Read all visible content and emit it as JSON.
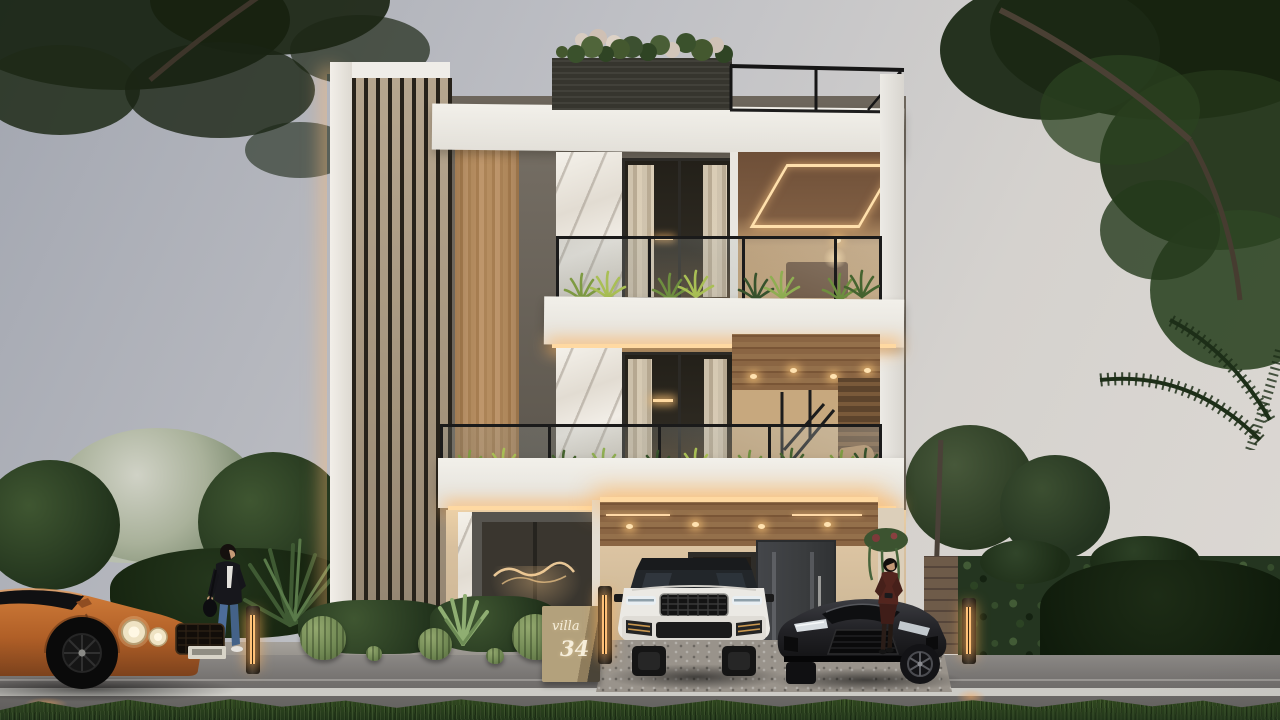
{
  "scene": {
    "description": "Photorealistic exterior render of a modern three-storey villa at dusk: warm LED accent lighting, rooftop flower planter with black railing, plant-lined glass balconies, vertical louver and wood cladding, marble piers, a carport with a white luxury SUV and a black sports coupe parked, an orange grand-tourer passing on the wet road, a woman walking on the sidewalk, a woman leaning on the sports car, cactus garden, hedges and trees under an overcast sky"
  },
  "sign": {
    "line1": "villa",
    "line2": "34"
  },
  "objects": {
    "suv": "white luxury SUV, front view",
    "sports_car": "black sports coupe, front view",
    "coupe": "orange grand tourer, side view, passing",
    "pedestrian": "woman walking with shoulder bag",
    "bystander": "woman leaning on the sports car"
  },
  "palette": {
    "sky_top": "#a2a6b0",
    "sky_bottom": "#dcd8d3",
    "facade_white": "#edebe6",
    "facade_beige": "#c9b69c",
    "wood": "#ae8659",
    "soffit_wood": "#8a6543",
    "marble": "#efebe3",
    "louver_dark": "#27221a",
    "led_warm": "#ffd9a2",
    "railing_black": "#1b1b1b",
    "plant_green": "#44602f",
    "hedge_green": "#243520",
    "grass_green": "#2c421f",
    "road_asphalt": "#716e6c",
    "lane_line": "#d9d8d3",
    "suv_white": "#e9e7e2",
    "sports_black": "#1f1f22",
    "coupe_orange": "#c06a2e",
    "sign_stone": "#ab9976",
    "door_dark": "#3c3e40"
  }
}
